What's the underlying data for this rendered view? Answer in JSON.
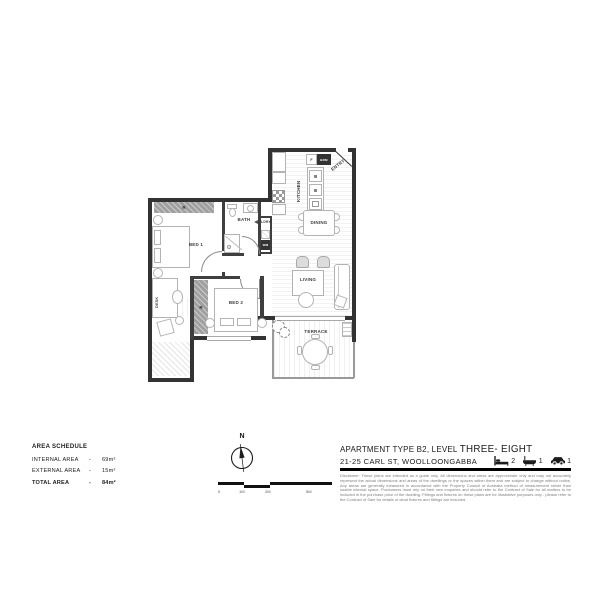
{
  "floor_plan": {
    "labels": {
      "bed1": "BED 1",
      "bed2": "BED 2",
      "bath": "BATH",
      "laundry": "LDRY",
      "washer": "WM",
      "kitchen": "KITCHEN",
      "dining": "DINING",
      "living": "LIVING",
      "terrace": "TERRACE",
      "entry": "ENTRY",
      "desk": "DESK",
      "robe": "R",
      "fridge": "F",
      "broom": "BRM"
    }
  },
  "area_schedule": {
    "title": "AREA SCHEDULE",
    "rows": [
      {
        "label": "INTERNAL AREA",
        "sep": "-",
        "value": "69m²"
      },
      {
        "label": "EXTERNAL AREA",
        "sep": "-",
        "value": "15m²"
      },
      {
        "label": "TOTAL AREA",
        "sep": "-",
        "value": "84m²"
      }
    ]
  },
  "compass": {
    "north": "N"
  },
  "scale_bar": {
    "labels": [
      "0",
      "1M",
      "2M",
      "5M"
    ]
  },
  "title_block": {
    "line1_prefix": "APARTMENT TYPE B2, LEVEL ",
    "line1_emphasis": "THREE- EIGHT",
    "line2": "21-25 CARL ST, WOOLLOONGABBA",
    "stats": [
      {
        "name": "bedrooms",
        "value": "2"
      },
      {
        "name": "bathrooms",
        "value": "1"
      },
      {
        "name": "carparks",
        "value": "1"
      }
    ],
    "disclaimer": "Disclaimer: These plans are intended as a guide only. All dimensions and areas are approximate only and may not accurately represent the actual dimensions and areas of the dwellings or the spaces within them and are subject to change without notice. Any areas are generally measured in accordance with the Property Council of Australia method of measurement rather than usable internal space. Purchasers must rely on their own enquiries and should refer to the Contract of Sale for all matters to be included in the purchase price of the dwelling. Fittings and fixtures on these plans are for illustrative purposes only - please refer to the Contract of Sale for details of what fixtures and fittings are included."
  },
  "colors": {
    "wall": "#333333",
    "rule": "#000000",
    "robe_fill": "#a0a0a0"
  }
}
